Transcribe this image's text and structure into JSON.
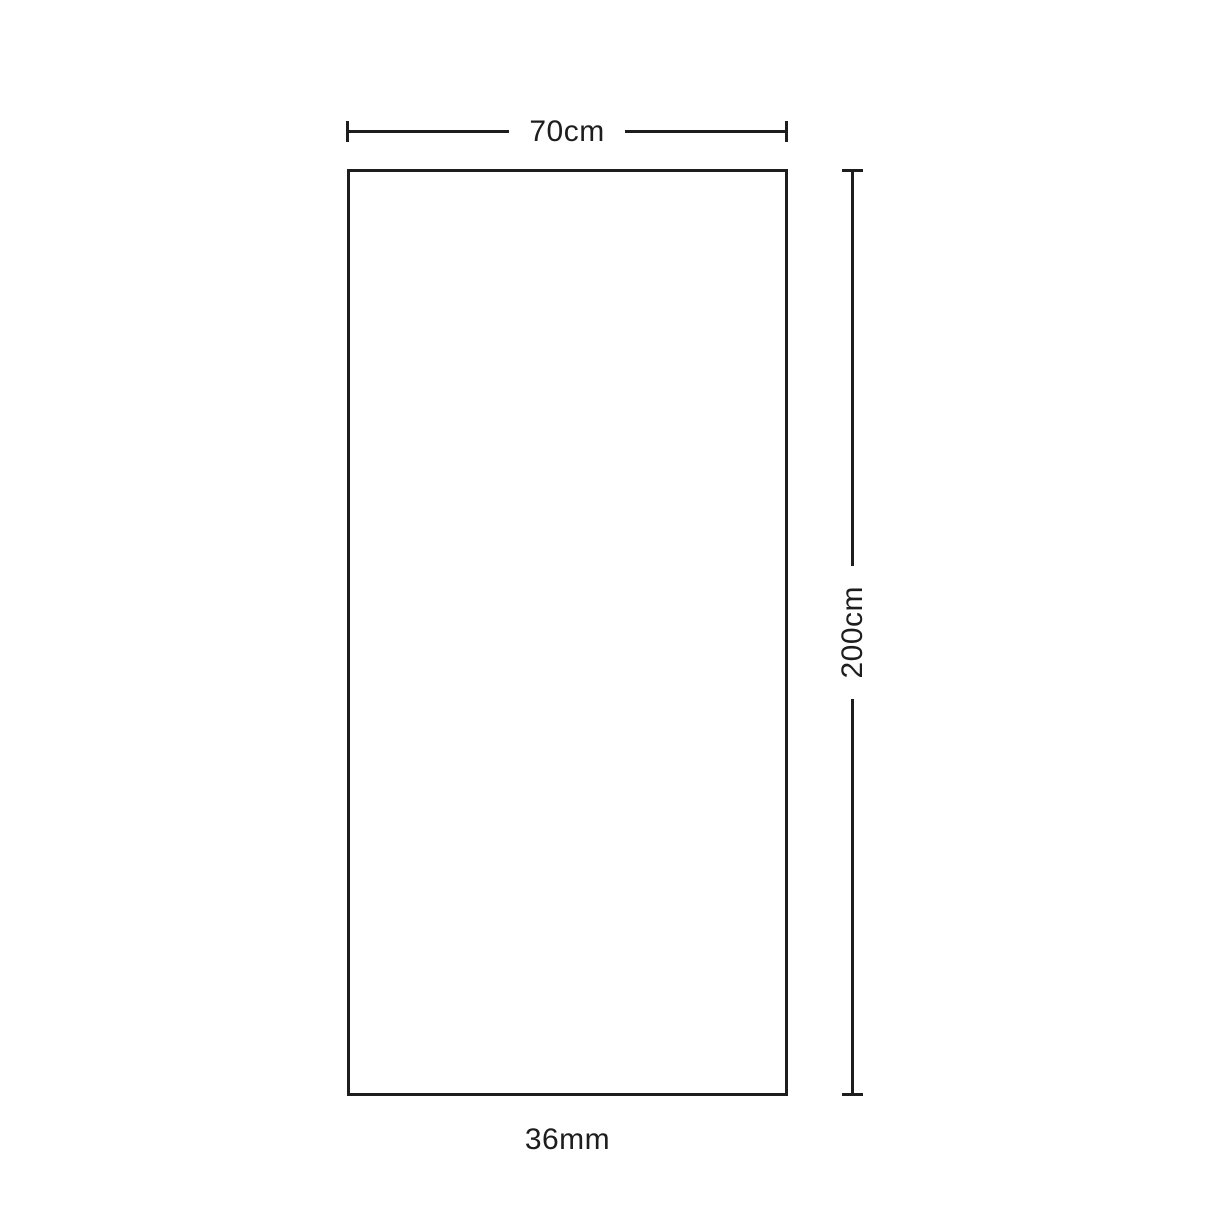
{
  "diagram": {
    "shape": "rectangle",
    "width_label": "70cm",
    "height_label": "200cm",
    "thickness_label": "36mm",
    "colors": {
      "line": "#1d1d1d",
      "background": "#ffffff"
    }
  }
}
